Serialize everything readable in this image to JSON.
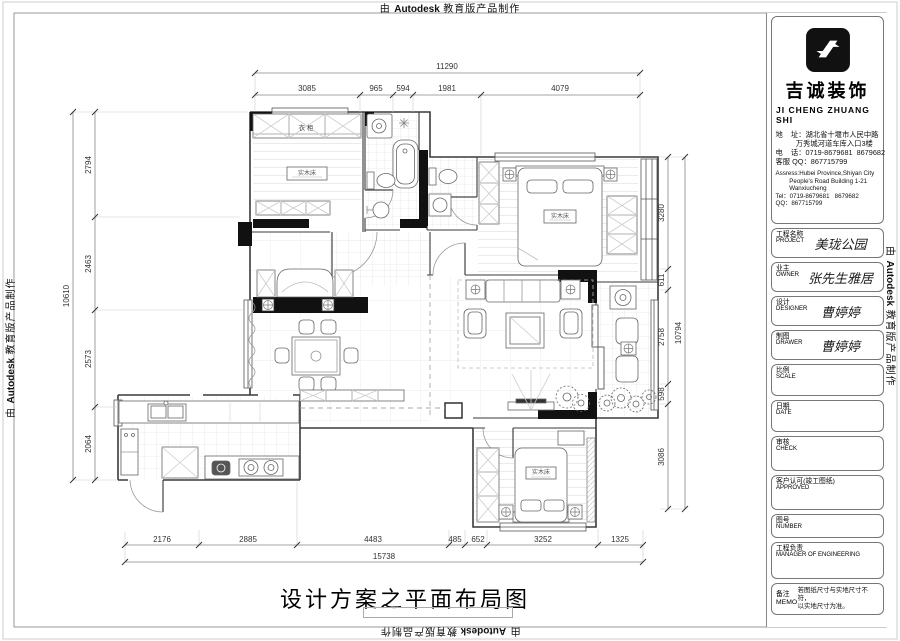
{
  "page": {
    "watermark": {
      "prefix": "由 ",
      "brand": "Autodesk",
      "suffix": " 教育版产品制作"
    },
    "caption": "设计方案之平面布局图"
  },
  "company": {
    "name_cn": "吉诚装饰",
    "name_en": "JI CHENG ZHUANG SHI",
    "lines_cn": [
      "地    址：湖北省十堰市人民中路",
      "          万秀城河道车库入口3楼",
      "电    话：0719-8679681  8679682",
      "客服 QQ：867715799"
    ],
    "lines_en": [
      "Assress:Hubei Province,Shiyan City",
      "        People's Road Building 1-21",
      "        Wanxiucheng",
      "Tel：0719-8679681   8679682",
      "QQ：867715799"
    ]
  },
  "titleblock": {
    "fields": [
      {
        "label_cn": "工程名称",
        "label_en": "PROJECT",
        "value": "美珑公园"
      },
      {
        "label_cn": "业主",
        "label_en": "OWNER",
        "value": "张先生雅居"
      },
      {
        "label_cn": "设计",
        "label_en": "DESIGNER",
        "value": "曹婷婷"
      },
      {
        "label_cn": "制图",
        "label_en": "DRAWER",
        "value": "曹婷婷"
      },
      {
        "label_cn": "比例",
        "label_en": "SCALE",
        "value": ""
      },
      {
        "label_cn": "日期",
        "label_en": "DATE",
        "value": ""
      },
      {
        "label_cn": "审核",
        "label_en": "CHECK",
        "value": ""
      },
      {
        "label_cn": "客户认可(竣工图纸)",
        "label_en": "APPROVED",
        "value": ""
      },
      {
        "label_cn": "图号",
        "label_en": "NUMBER",
        "value": ""
      },
      {
        "label_cn": "工程负责",
        "label_en": "MANAGER OF ENGINEERING",
        "value": ""
      }
    ],
    "memo": {
      "label_cn": "备注",
      "label_en": "MEMO",
      "line1": "若图纸尺寸与实地尺寸不符，",
      "line2": "以实地尺寸为准。"
    }
  },
  "plan": {
    "dims": {
      "top_total": "11290",
      "top": [
        "3085",
        "965",
        "594",
        "1981",
        "4079"
      ],
      "left_total": "10610",
      "left": [
        "2794",
        "2463",
        "2573",
        "2064"
      ],
      "right_total": "10794",
      "right": [
        "3280",
        "611",
        "2758",
        "598",
        "3086"
      ],
      "bottom_total": "15738",
      "bottom": [
        "2176",
        "2885",
        "4483",
        "485",
        "652",
        "3252",
        "1325"
      ]
    },
    "labels": {
      "wardrobe": "衣柜",
      "bed_master": "实木床",
      "bed_second": "实木床",
      "bed_third": "实木床"
    }
  }
}
